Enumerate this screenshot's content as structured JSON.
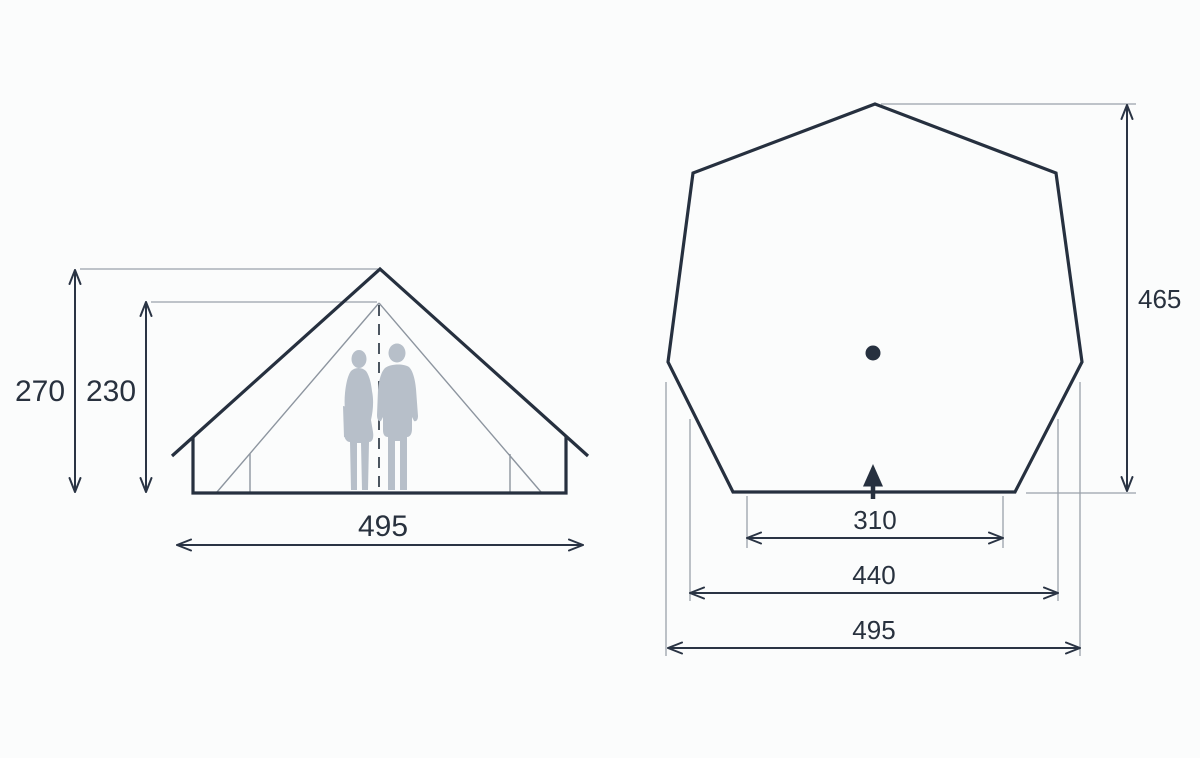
{
  "colors": {
    "outline": "#26303f",
    "dimension_line": "#2a3444",
    "extension_line": "#9aa1aa",
    "inner_tent_line": "#8d959f",
    "silhouette": "#b7bfc9",
    "label_text": "#28313e",
    "background": "#fbfcfc"
  },
  "side_view": {
    "height_total": "270",
    "height_inner": "230",
    "width": "495"
  },
  "plan_view": {
    "depth": "465",
    "front_width": "310",
    "floor_width": "440",
    "max_width": "495"
  }
}
